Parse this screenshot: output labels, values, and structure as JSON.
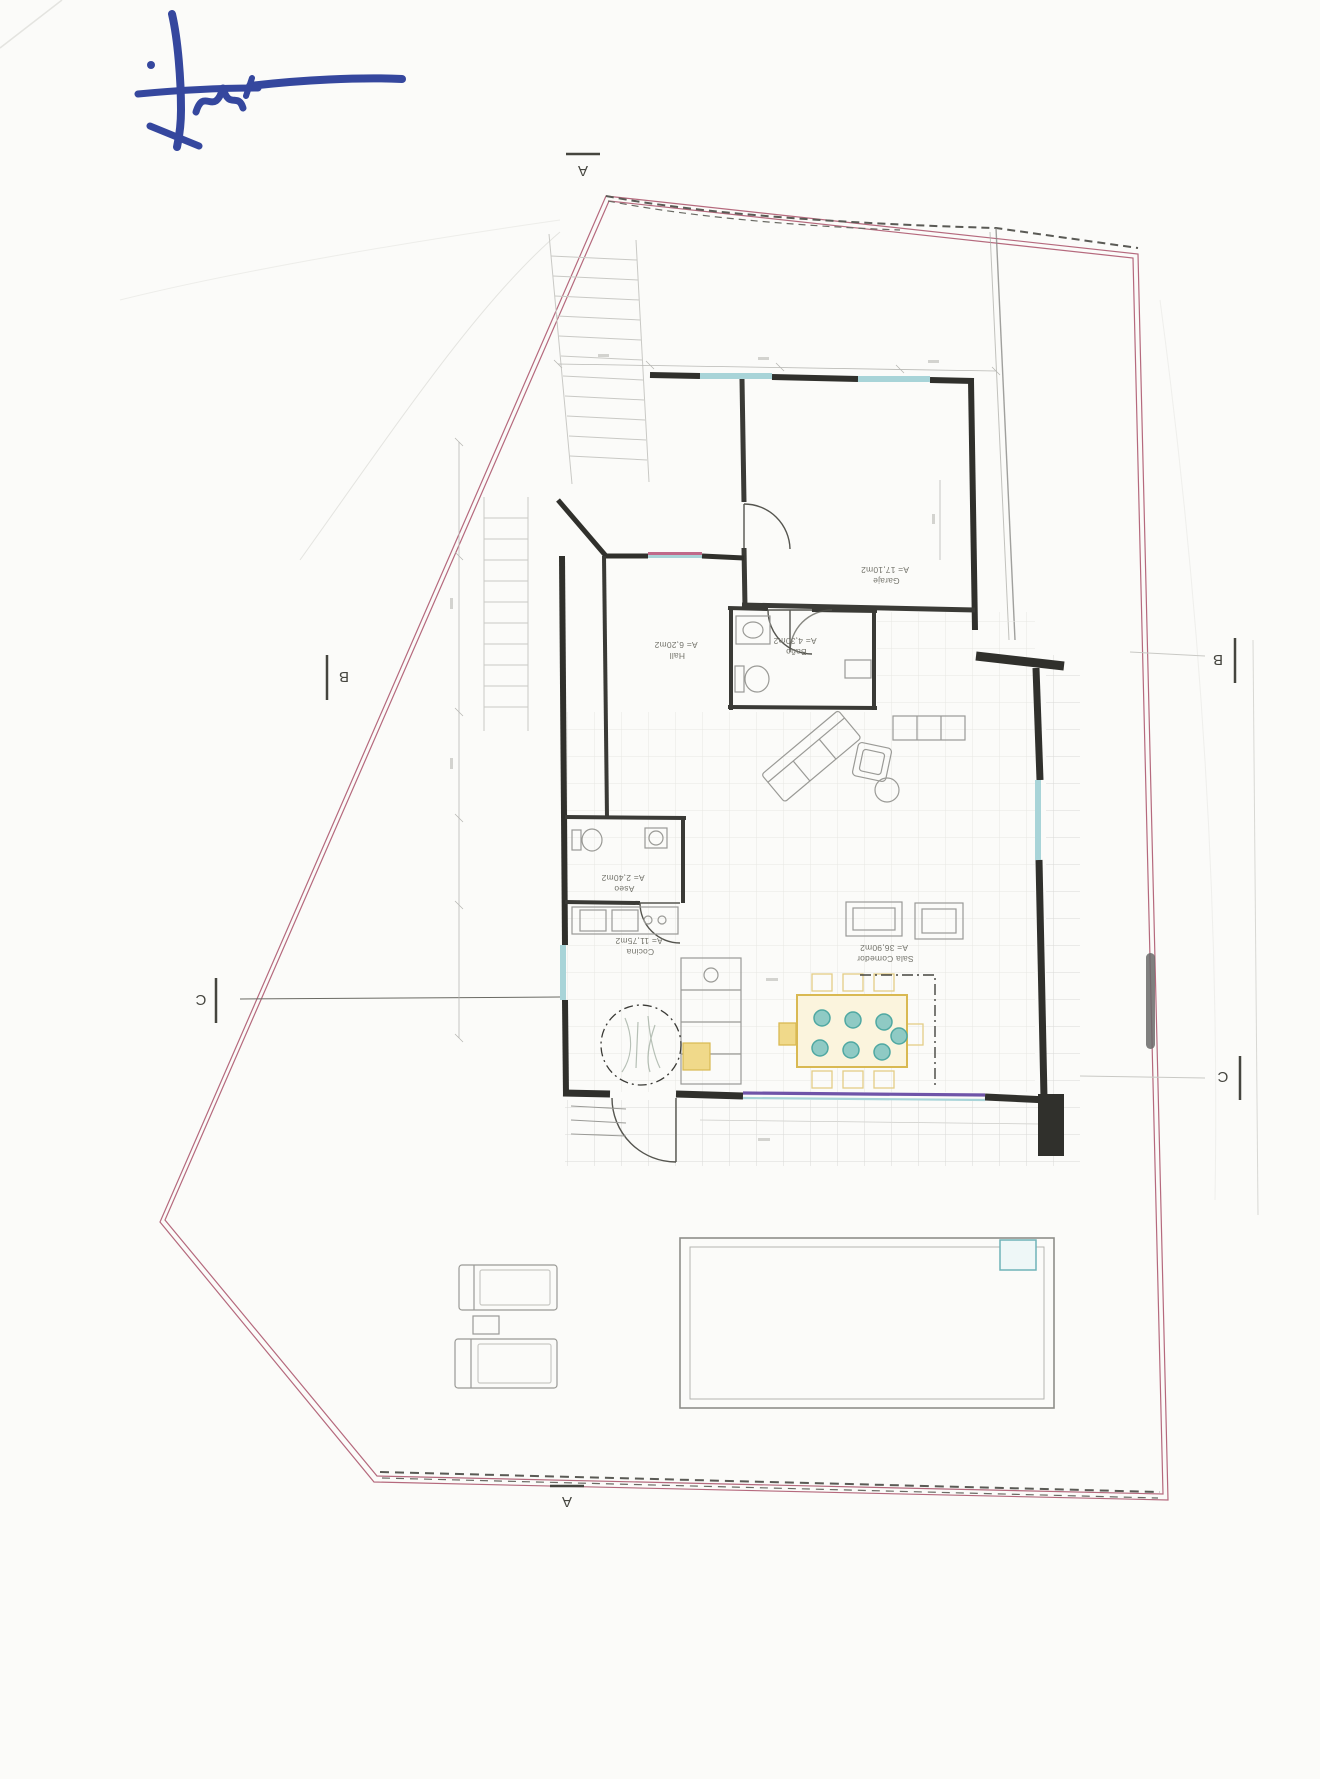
{
  "document": {
    "kind": "scanned architectural floor plan, rotated 180 degrees, hand-signed in blue ink"
  },
  "markers": {
    "a_top": "A",
    "a_bottom": "A",
    "b_left": "B",
    "b_right": "B",
    "c_left": "C",
    "c_right": "C"
  },
  "rooms": [
    {
      "id": "garaje",
      "name": "Garaje",
      "area": "A= 17,10m2"
    },
    {
      "id": "hall",
      "name": "Hall",
      "area": "A= 6,20m2"
    },
    {
      "id": "bano",
      "name": "Baño",
      "area": "A= 4,30m2"
    },
    {
      "id": "aseo",
      "name": "Aseo",
      "area": "A= 2,40m2"
    },
    {
      "id": "cocina",
      "name": "Cocina",
      "area": "A= 11,75m2"
    },
    {
      "id": "sala_comedor",
      "name": "Sala Comedor",
      "area": "A= 36,90m2"
    }
  ],
  "colors": {
    "paper": "#fbfbf9",
    "plot_boundary_pink": "#b5697d",
    "boundary_dashed_dark": "#5a5a55",
    "wall_black": "#30302c",
    "window_cyan": "#a8d4d8",
    "window_sill_pink": "#c06a8a",
    "window_band_purple": "#6f54a8",
    "dining_yellow": "#d9b952",
    "chair_teal": "#4fa8a2",
    "signature_blue": "#35479e",
    "label_gray": "#74746c",
    "scrollbar_gray": "#6a6a6a"
  }
}
